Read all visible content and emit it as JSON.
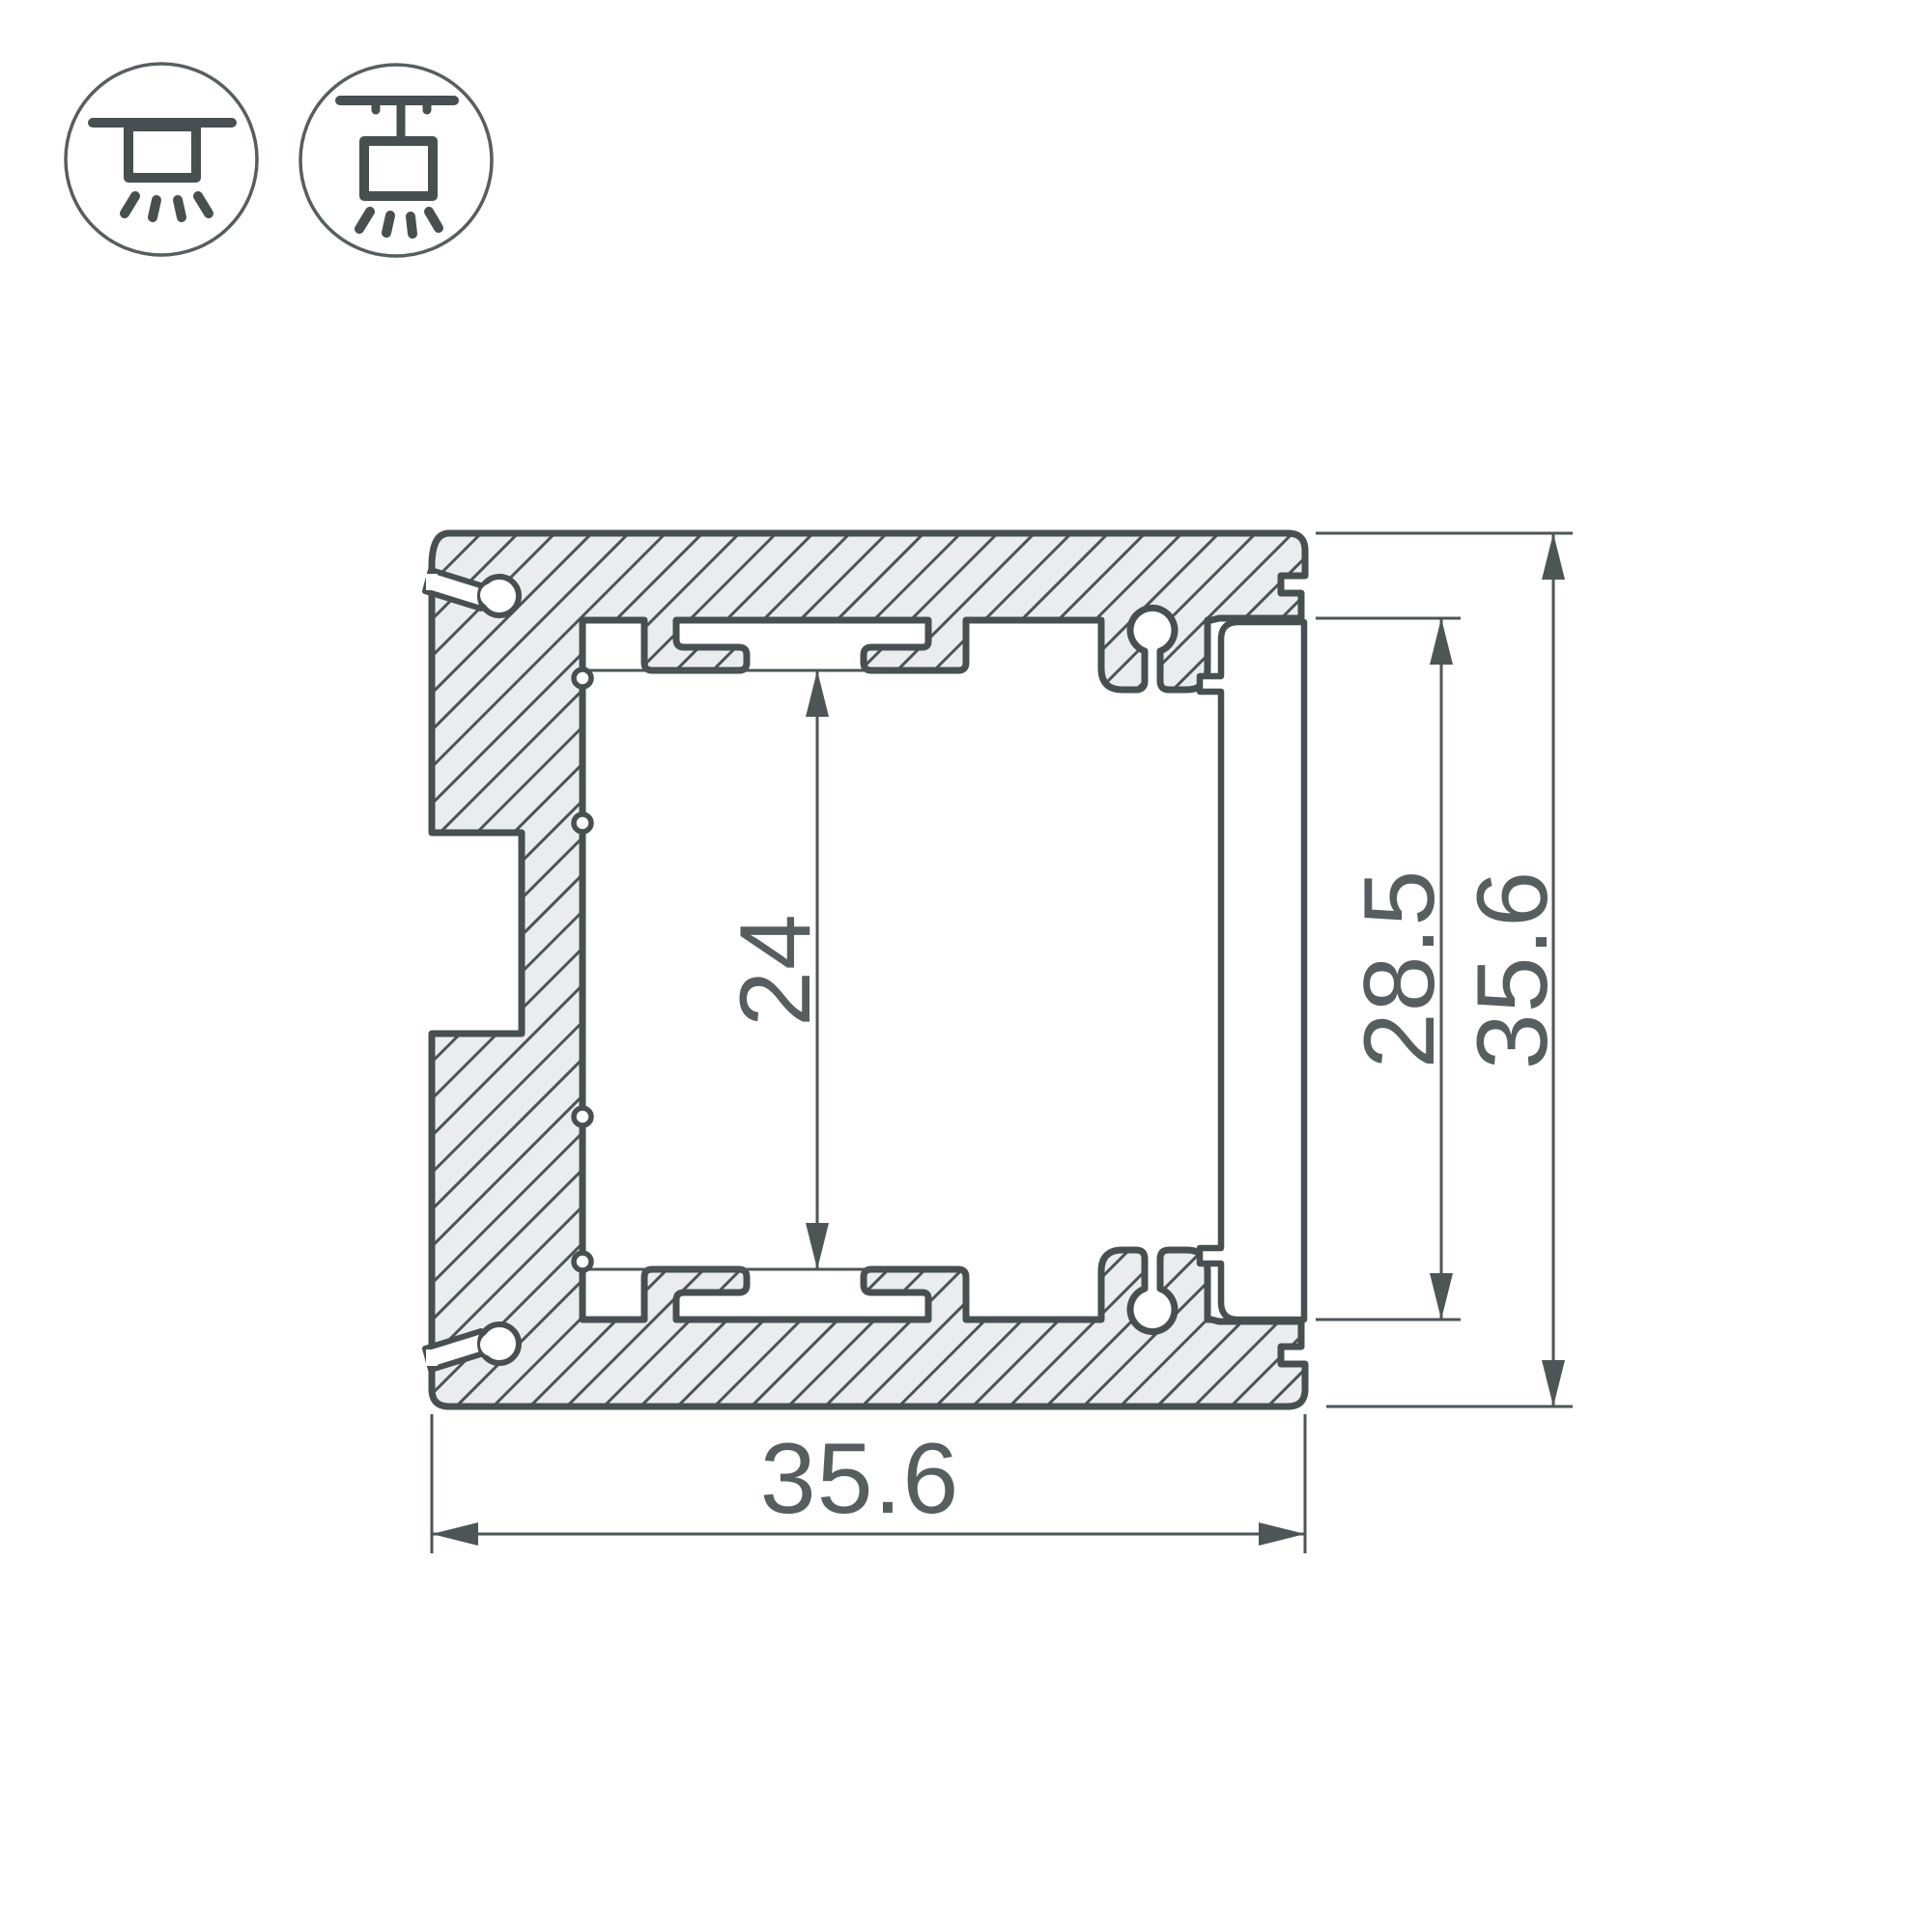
{
  "drawing": {
    "title": "aluminum-led-profile-cross-section",
    "type": "technical-drawing"
  },
  "legend_icons": [
    {
      "name": "surface-mount-luminaire"
    },
    {
      "name": "suspended-luminaire"
    }
  ],
  "dimensions": {
    "channel_height": {
      "label": "24"
    },
    "inner_height": {
      "label": "28.5"
    },
    "outer_height": {
      "label": "35.6"
    },
    "outer_width": {
      "label": "35.6"
    }
  },
  "colors": {
    "outline": "#474f51",
    "hatch_fill": "#eaeced",
    "hatch_line": "#4b5456",
    "dimension_line": "#4d5557",
    "dimension_text": "#565e60",
    "background": "#ffffff"
  }
}
